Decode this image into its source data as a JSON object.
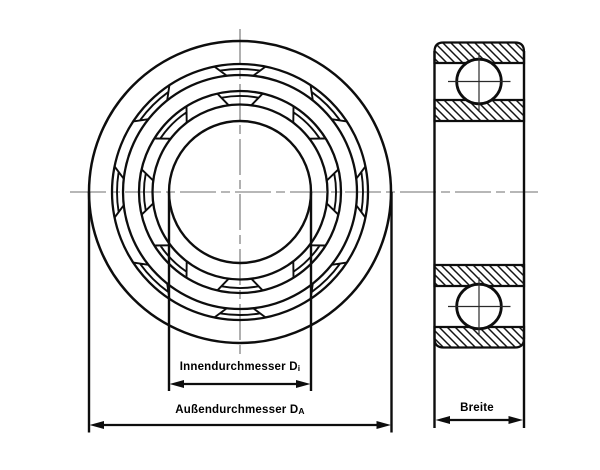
{
  "diagram": {
    "dimension_labels": {
      "inner": {
        "text": "Innendurchmesser D",
        "subscript": "i"
      },
      "outer": {
        "text": "Außendurchmesser D",
        "subscript": "A"
      },
      "width": {
        "text": "Breite",
        "subscript": ""
      }
    },
    "colors": {
      "line": "#0d0d0d",
      "centerline": "#6f6f6f",
      "background": "#ffffff",
      "text": "#000000"
    }
  }
}
